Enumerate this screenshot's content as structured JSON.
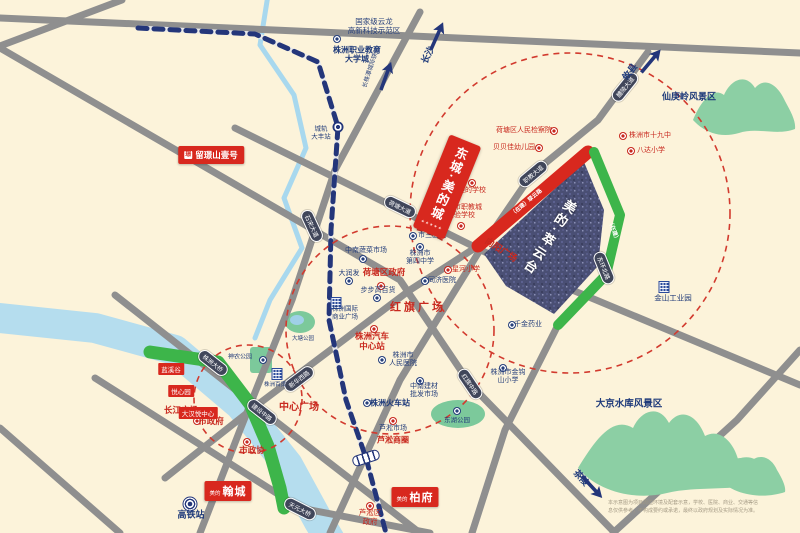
{
  "colors": {
    "bg": "#fcf3da",
    "road": "#8f8f8f",
    "river": "#b5ddee",
    "stream": "#a8d8ee",
    "green": "#3db54a",
    "park": "#7cc99b",
    "red": "#c8281e",
    "navy": "#27407c",
    "rail": "#24367a",
    "oval_bg": "#40465a",
    "parcel": "#4a4f74",
    "mountain": "#8ccfa4",
    "circle": "#d23a2e"
  },
  "geo": {
    "river": [
      [
        0,
        318
      ],
      [
        95,
        328
      ],
      [
        175,
        350
      ],
      [
        240,
        405
      ],
      [
        288,
        465
      ],
      [
        318,
        520
      ],
      [
        330,
        540
      ]
    ],
    "stream": [
      [
        268,
        -5
      ],
      [
        260,
        45
      ],
      [
        294,
        95
      ],
      [
        306,
        148
      ],
      [
        284,
        198
      ],
      [
        302,
        248
      ],
      [
        270,
        300
      ],
      [
        255,
        338
      ]
    ],
    "pond": {
      "cx": 300,
      "cy": 322,
      "rx": 15,
      "ry": 11
    },
    "parks": [
      {
        "shape": "rect",
        "x": 250,
        "y": 347,
        "w": 22,
        "h": 26,
        "name": "shennong-park-area"
      },
      {
        "shape": "ellipse",
        "cx": 458,
        "cy": 414,
        "rx": 27,
        "ry": 14,
        "name": "donghu-park-area"
      }
    ],
    "greenway": [
      [
        150,
        352
      ],
      [
        218,
        362
      ],
      [
        250,
        404
      ],
      [
        268,
        446
      ],
      [
        280,
        488
      ],
      [
        284,
        508
      ]
    ],
    "roads": [
      {
        "name": "top-road",
        "pts": [
          [
            0,
            18
          ],
          [
            800,
            53
          ]
        ]
      },
      {
        "name": "topleft-road",
        "pts": [
          [
            122,
            0
          ],
          [
            0,
            46
          ]
        ]
      },
      {
        "name": "hongqi-road",
        "pts": [
          [
            0,
            48
          ],
          [
            400,
            280
          ],
          [
            470,
            384
          ],
          [
            615,
            533
          ]
        ]
      },
      {
        "name": "shisong-avenue",
        "pts": [
          [
            420,
            12
          ],
          [
            335,
            170
          ],
          [
            292,
            300
          ],
          [
            240,
            430
          ],
          [
            200,
            533
          ]
        ]
      },
      {
        "name": "liling-avenue",
        "pts": [
          [
            648,
            52
          ],
          [
            598,
            120
          ],
          [
            532,
            174
          ],
          [
            480,
            250
          ],
          [
            400,
            380
          ],
          [
            330,
            533
          ]
        ]
      },
      {
        "name": "hetang-avenue",
        "pts": [
          [
            235,
            128
          ],
          [
            505,
            262
          ],
          [
            800,
            385
          ]
        ]
      },
      {
        "name": "xinhua-road",
        "pts": [
          [
            165,
            478
          ],
          [
            256,
            406
          ],
          [
            410,
            290
          ],
          [
            478,
            246
          ]
        ]
      },
      {
        "name": "jianshe-road",
        "pts": [
          [
            115,
            295
          ],
          [
            256,
            406
          ],
          [
            420,
            533
          ]
        ]
      },
      {
        "name": "tianyuan-bridge-road",
        "pts": [
          [
            95,
            378
          ],
          [
            300,
            508
          ],
          [
            430,
            533
          ]
        ]
      },
      {
        "name": "donghuan-south",
        "pts": [
          [
            558,
            325
          ],
          [
            505,
            430
          ],
          [
            472,
            533
          ]
        ]
      },
      {
        "name": "southeast-road",
        "pts": [
          [
            800,
            350
          ],
          [
            737,
            420
          ],
          [
            613,
            533
          ]
        ]
      },
      {
        "name": "corner-road",
        "pts": [
          [
            0,
            428
          ],
          [
            120,
            533
          ]
        ]
      }
    ],
    "railway": [
      [
        138,
        28
      ],
      [
        255,
        34
      ],
      [
        318,
        62
      ],
      [
        338,
        127
      ],
      [
        331,
        230
      ],
      [
        329,
        320
      ],
      [
        346,
        400
      ],
      [
        366,
        458
      ],
      [
        386,
        533
      ]
    ],
    "parcel": [
      [
        484,
        254
      ],
      [
        584,
        162
      ],
      [
        604,
        210
      ],
      [
        598,
        266
      ],
      [
        554,
        314
      ],
      [
        506,
        286
      ]
    ],
    "strip_red": [
      [
        478,
        246
      ],
      [
        588,
        152
      ]
    ],
    "strip_green": [
      [
        594,
        152
      ],
      [
        620,
        215
      ],
      [
        606,
        275
      ],
      [
        558,
        325
      ]
    ],
    "circles": [
      {
        "cx": 570,
        "cy": 213,
        "r": 160
      },
      {
        "cx": 390,
        "cy": 330,
        "r": 104
      },
      {
        "cx": 248,
        "cy": 399,
        "r": 54
      }
    ],
    "mountains": [
      "M693 120 C700 103 712 86 724 95 C731 79 746 73 755 88 C765 76 778 85 785 101 C791 112 796 121 795 129 C777 136 757 127 739 133 C719 139 703 131 693 120 Z",
      "M578 468 C594 442 612 415 633 428 C641 410 659 404 669 423 C681 407 697 415 705 436 C719 428 733 441 738 459 C752 453 766 463 770 479 C741 493 700 485 667 493 C634 501 597 491 578 468 Z",
      "M716 476 C726 462 740 452 750 462 C760 452 772 458 777 470 C783 480 786 487 785 492 C765 499 733 497 716 476 Z"
    ]
  },
  "road_badges": [
    {
      "t": "石宋大道",
      "x": 312,
      "y": 226,
      "r": 65
    },
    {
      "t": "荷塘大道",
      "x": 400,
      "y": 207,
      "r": 26
    },
    {
      "t": "醴陵大道",
      "x": 625,
      "y": 87,
      "r": -51
    },
    {
      "t": "职教大道",
      "x": 533,
      "y": 174,
      "r": -40
    },
    {
      "t": "东环北路",
      "x": 604,
      "y": 268,
      "r": 68
    },
    {
      "t": "新华西路",
      "x": 299,
      "y": 379,
      "r": -37
    },
    {
      "t": "株洲大桥",
      "x": 213,
      "y": 363,
      "r": 38
    },
    {
      "t": "建设中路",
      "x": 262,
      "y": 412,
      "r": 38
    },
    {
      "t": "天元大桥",
      "x": 300,
      "y": 509,
      "r": 27
    },
    {
      "t": "红旗中路",
      "x": 470,
      "y": 384,
      "r": 56
    }
  ],
  "labels": [
    {
      "t": "国家级云龙\n高新科技示范区",
      "x": 374,
      "y": 27,
      "c": "navy",
      "fs": 7.5
    },
    {
      "t": "株洲职业教育\n大学城",
      "x": 357,
      "y": 55,
      "c": "navy-b",
      "fs": 8
    },
    {
      "t": "城轨\n大丰站",
      "x": 321,
      "y": 133,
      "c": "navy",
      "fs": 6.5
    },
    {
      "t": "市三医院",
      "x": 432,
      "y": 236,
      "c": "navy",
      "fs": 7
    },
    {
      "t": "株洲市\n第四中学",
      "x": 420,
      "y": 258,
      "c": "navy",
      "fs": 7
    },
    {
      "t": "中南蔬菜市场",
      "x": 366,
      "y": 251,
      "c": "navy",
      "fs": 7
    },
    {
      "t": "大润发",
      "x": 349,
      "y": 274,
      "c": "navy",
      "fs": 7
    },
    {
      "t": "同济医院",
      "x": 442,
      "y": 281,
      "c": "navy",
      "fs": 7
    },
    {
      "t": "步步高百货",
      "x": 378,
      "y": 291,
      "c": "navy",
      "fs": 7
    },
    {
      "t": "株洲国际\n商业广场",
      "x": 345,
      "y": 313,
      "c": "navy",
      "fs": 6.5
    },
    {
      "t": "株洲市\n人民医院",
      "x": 403,
      "y": 360,
      "c": "navy",
      "fs": 7
    },
    {
      "t": "千金药业",
      "x": 528,
      "y": 325,
      "c": "navy",
      "fs": 7
    },
    {
      "t": "株洲市金钩\n山小学",
      "x": 508,
      "y": 377,
      "c": "navy",
      "fs": 7
    },
    {
      "t": "中南建材\n批发市场",
      "x": 424,
      "y": 391,
      "c": "navy",
      "fs": 7
    },
    {
      "t": "株洲火车站",
      "x": 390,
      "y": 403,
      "c": "navy-b",
      "fs": 8
    },
    {
      "t": "芦淞市场",
      "x": 393,
      "y": 429,
      "c": "navy",
      "fs": 7
    },
    {
      "t": "神农公园",
      "x": 240,
      "y": 358,
      "c": "navy",
      "fs": 6
    },
    {
      "t": "株洲百货",
      "x": 275,
      "y": 385,
      "c": "navy",
      "fs": 5.5
    },
    {
      "t": "东湖公园",
      "x": 457,
      "y": 421,
      "c": "navy",
      "fs": 6.5
    },
    {
      "t": "大塘公园",
      "x": 303,
      "y": 339,
      "c": "navy",
      "fs": 5.5
    },
    {
      "t": "高铁站",
      "x": 191,
      "y": 515,
      "c": "navy-b",
      "fs": 9
    },
    {
      "t": "金山工业园",
      "x": 673,
      "y": 299,
      "c": "navy",
      "fs": 7.5
    },
    {
      "t": "仙庚岭风景区",
      "x": 689,
      "y": 97,
      "c": "navy-b",
      "fs": 9
    },
    {
      "t": "大京水库风景区",
      "x": 629,
      "y": 404,
      "c": "navy-b",
      "fs": 9.5
    },
    {
      "t": "荷塘区人民检察院",
      "x": 524,
      "y": 131,
      "c": "red",
      "fs": 7
    },
    {
      "t": "贝贝佳幼儿园",
      "x": 514,
      "y": 148,
      "c": "red",
      "fs": 7
    },
    {
      "t": "株洲市十九中",
      "x": 650,
      "y": 136,
      "c": "red",
      "fs": 7
    },
    {
      "t": "八达小学",
      "x": 651,
      "y": 151,
      "c": "red",
      "fs": 7
    },
    {
      "t": "美的学校",
      "x": 472,
      "y": 191,
      "c": "red",
      "fs": 7
    },
    {
      "t": "株洲市职教城\n实验学校",
      "x": 461,
      "y": 212,
      "c": "red",
      "fs": 7
    },
    {
      "t": "星河小学",
      "x": 466,
      "y": 270,
      "c": "red",
      "fs": 7
    },
    {
      "t": "荷塘区政府",
      "x": 384,
      "y": 272,
      "c": "red-b",
      "fs": 8.5
    },
    {
      "t": "红旗广场",
      "x": 418,
      "y": 308,
      "c": "red-xl",
      "fs": 11
    },
    {
      "t": "株洲汽车\n中心站",
      "x": 372,
      "y": 341,
      "c": "red-b",
      "fs": 8.5
    },
    {
      "t": "向阳广场",
      "x": 501,
      "y": 250,
      "c": "red-b",
      "fs": 9,
      "r": 33
    },
    {
      "t": "长江广场",
      "x": 181,
      "y": 410,
      "c": "red-b",
      "fs": 8.5
    },
    {
      "t": "市政府",
      "x": 211,
      "y": 421,
      "c": "red-b",
      "fs": 8.5
    },
    {
      "t": "市政协",
      "x": 252,
      "y": 450,
      "c": "red-b",
      "fs": 8.5
    },
    {
      "t": "中心广场",
      "x": 299,
      "y": 408,
      "c": "red-b",
      "fs": 10
    },
    {
      "t": "芦淞商圈",
      "x": 393,
      "y": 440,
      "c": "red-b",
      "fs": 8
    },
    {
      "t": "芦淞区\n政府",
      "x": 370,
      "y": 518,
      "c": "red",
      "fs": 7.5
    },
    {
      "t": "长沙",
      "x": 428,
      "y": 55,
      "c": "navy-b",
      "fs": 9,
      "r": -65
    },
    {
      "t": "长株潭城际铁路",
      "x": 372,
      "y": 68,
      "c": "navy",
      "fs": 6,
      "r": -72
    },
    {
      "t": "攸县",
      "x": 630,
      "y": 72,
      "c": "navy-b",
      "fs": 9,
      "r": -52
    },
    {
      "t": "茶陵",
      "x": 581,
      "y": 478,
      "c": "navy-b",
      "fs": 9,
      "r": 48
    },
    {
      "t": "（在建）翠云路",
      "x": 527,
      "y": 203,
      "c": "white",
      "fs": 5.5,
      "r": -40
    },
    {
      "t": "（在建）",
      "x": 613,
      "y": 231,
      "c": "white",
      "fs": 5.5,
      "r": 70
    }
  ],
  "icons": {
    "dots_red": [
      [
        554,
        131
      ],
      [
        539,
        148
      ],
      [
        623,
        136
      ],
      [
        631,
        151
      ],
      [
        472,
        183
      ],
      [
        461,
        226
      ],
      [
        448,
        270
      ],
      [
        381,
        286
      ],
      [
        374,
        329
      ],
      [
        197,
        421
      ],
      [
        247,
        442
      ],
      [
        370,
        506
      ],
      [
        393,
        421
      ]
    ],
    "dots_navy": [
      [
        337,
        39
      ],
      [
        413,
        236
      ],
      [
        420,
        247
      ],
      [
        363,
        259
      ],
      [
        349,
        281
      ],
      [
        425,
        281
      ],
      [
        377,
        298
      ],
      [
        382,
        360
      ],
      [
        512,
        325
      ],
      [
        503,
        368
      ],
      [
        420,
        381
      ],
      [
        367,
        403
      ],
      [
        263,
        360
      ],
      [
        457,
        411
      ]
    ],
    "bldg": [
      [
        277,
        374
      ],
      [
        664,
        287
      ],
      [
        336,
        303
      ]
    ],
    "station_circle": [
      338,
      127
    ],
    "station_capsule": {
      "x": 366,
      "y": 458,
      "r": 72
    },
    "rail_hub": [
      190,
      504
    ]
  },
  "badges": {
    "liujing": {
      "logo": "璟",
      "t": "留璟山壹号",
      "x": 211,
      "y": 155,
      "fs": 8.5
    },
    "banner": {
      "t": "东城·美的城",
      "stars": "★★★★★",
      "x": 447,
      "y": 187,
      "w": 34,
      "h": 100,
      "r": 22,
      "fs": 12.5
    },
    "hancheng": {
      "small": "美的",
      "big": "翰城",
      "x": 228,
      "y": 491
    },
    "baifu": {
      "small": "美的",
      "big": "柏府",
      "x": 415,
      "y": 497
    },
    "minis": [
      {
        "t": "蓝溪谷",
        "x": 171,
        "y": 369
      },
      {
        "t": "悦心园",
        "x": 181,
        "y": 391
      },
      {
        "t": "大汉悦中心",
        "x": 198,
        "y": 413
      }
    ],
    "parcel_label": {
      "t": "美的·萃云台",
      "x": 549,
      "y": 237,
      "r": 33,
      "fs": 13
    }
  },
  "arrows": [
    {
      "x": 437,
      "y": 36,
      "r": 24
    },
    {
      "x": 386,
      "y": 76,
      "r": 20
    },
    {
      "x": 651,
      "y": 61,
      "r": 40
    },
    {
      "x": 592,
      "y": 487,
      "r": 137
    }
  ],
  "disclaimer": {
    "t": "本示意图为项目周边环境及配套示意，学校、医院、商业、交通等信息仅供参考，不构成要约或承诺，最终以政府规划及实际情况为准。"
  }
}
